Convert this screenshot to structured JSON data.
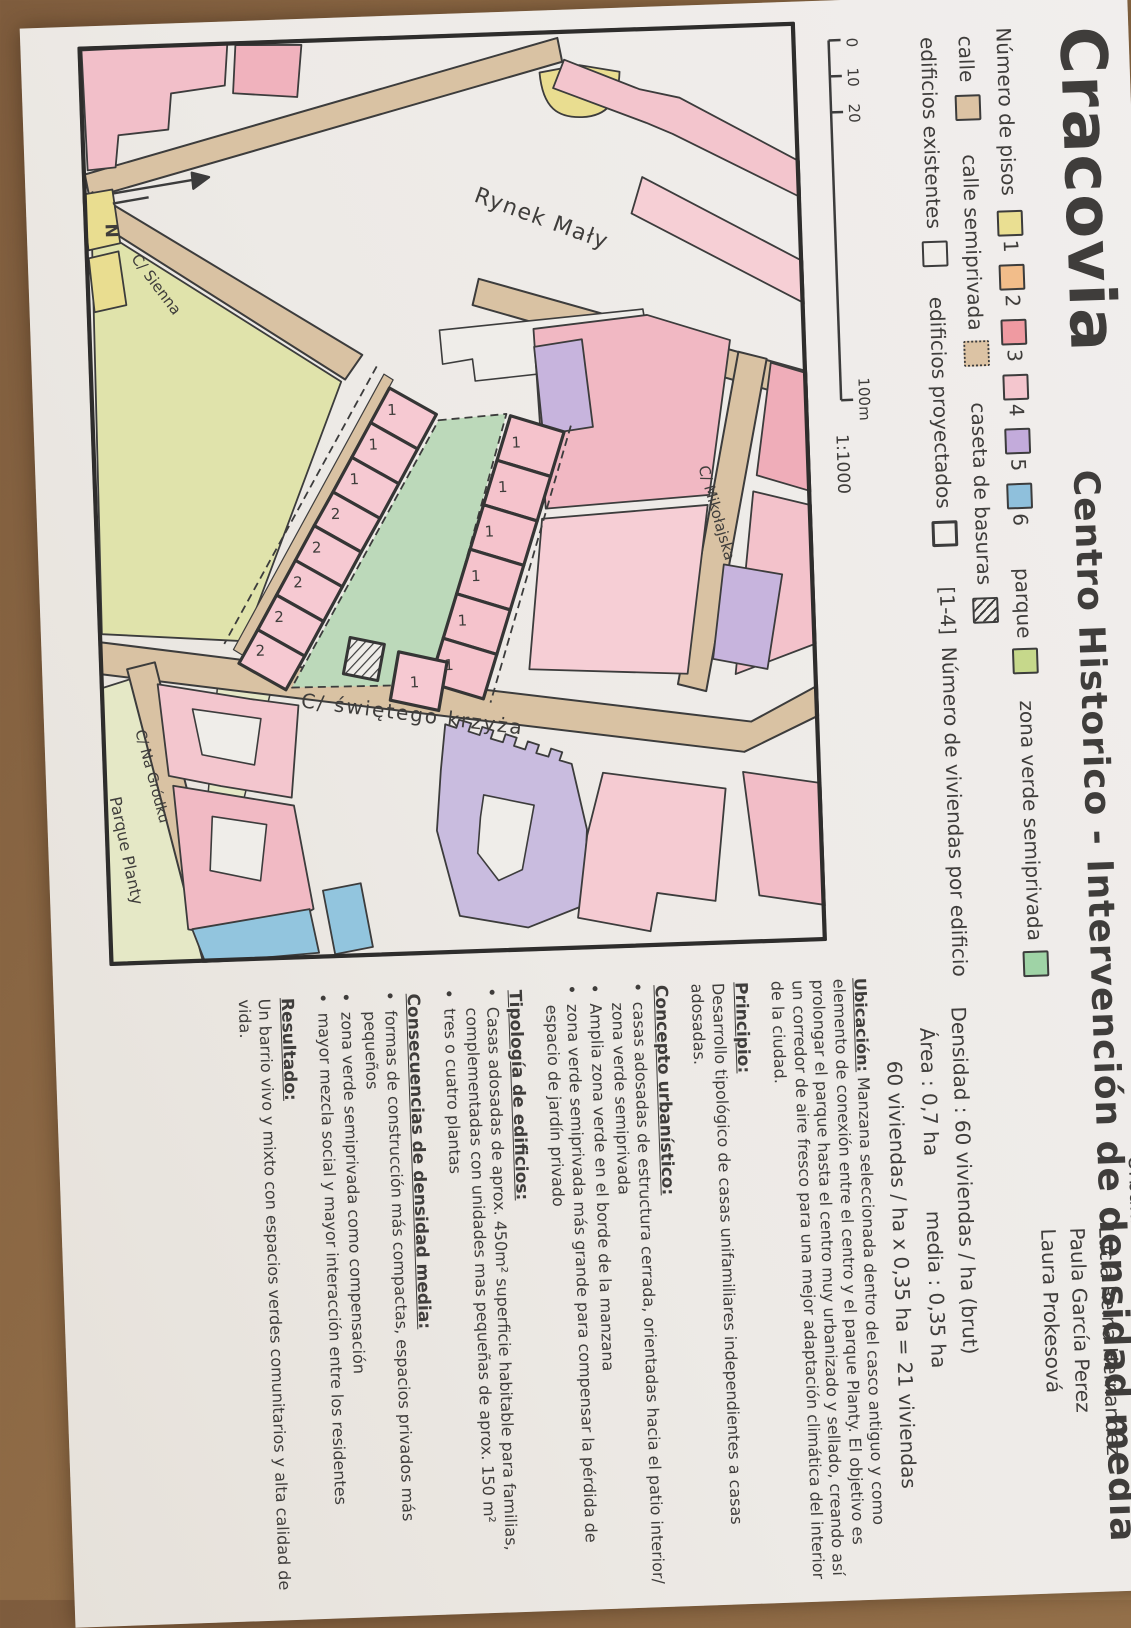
{
  "header": {
    "title_main": "Cracovia",
    "title_sub": "Centro Historico - Intervención de densidad media",
    "course": "Urbanismo 1",
    "term": "25/26",
    "group": "Grupo A",
    "authors": [
      "Lucía Reina Hernandez",
      "Paula García Perez",
      "Laura Prokesová"
    ]
  },
  "legend": {
    "pisos_label": "Número de pisos",
    "pisos": [
      {
        "n": "1",
        "color": "#eadf92"
      },
      {
        "n": "2",
        "color": "#f2bd8a"
      },
      {
        "n": "3",
        "color": "#ef9aa1"
      },
      {
        "n": "4",
        "color": "#f4c6ce"
      },
      {
        "n": "5",
        "color": "#c3abdb"
      },
      {
        "n": "6",
        "color": "#8fc0dc"
      }
    ],
    "parque_label": "parque",
    "parque_color": "#c6d88b",
    "zona_label": "zona verde semiprivada",
    "zona_color": "#9fd3a6",
    "calle_label": "calle",
    "calle_color": "#dcc3a4",
    "calle_semi_label": "calle semiprivada",
    "calle_semi_color": "#dcc3a4",
    "caseta_label": "caseta de basuras",
    "edif_exist_label": "edificios existentes",
    "edif_proy_label": "edificios proyectados",
    "viviendas_note_prefix": "[1-4]",
    "viviendas_note": "Número de viviendas por edificio"
  },
  "scale": {
    "ticks": [
      "0",
      "10",
      "20"
    ],
    "end": "100m",
    "ratio": "1:1000"
  },
  "density": {
    "line1": "Densidad : 60 viviendas / ha (brut)",
    "line2_area": "Área :  0,7 ha",
    "line2_media": "media :  0,35 ha",
    "line3": "60 viviendas / ha  x  0,35 ha = 21 viviendas"
  },
  "map": {
    "north_label": "N",
    "labels": {
      "rynek": "Rynek Mały",
      "sienna": "C/ Sienna",
      "mikolajska": "C/ Mikołajska",
      "krzyza": "C/ świętego krzyża",
      "grodku": "C/ Na Gródku",
      "planty": "Parque Planty"
    },
    "house_numbers": {
      "west": [
        "1",
        "1",
        "1",
        "2",
        "2",
        "2",
        "2",
        "2"
      ],
      "east": [
        "1",
        "1",
        "1",
        "1",
        "1",
        "1"
      ],
      "extra": [
        "1"
      ]
    }
  },
  "notes": {
    "ubicacion_title": "Ubicación:",
    "ubicacion_text": "Manzana seleccionada dentro del casco antiguo y como elemento de conexión entre el centro y el parque Planty. El objetivo es prolongar el parque hasta el centro muy urbanizado y sellado, creando así un corredor de aire fresco para una mejor adaptación climática del interior de la ciudad.",
    "principio_title": "Principio:",
    "principio_text": "Desarrollo tipológico de casas unifamiliares independientes a casas adosadas.",
    "concepto_title": "Concepto urbanístico:",
    "concepto_bullets": [
      "casas adosadas de estructura cerrada, orientadas hacia el patio interior/ zona verde semiprivada",
      "Amplia zona verde en el borde de la manzana",
      "zona verde semiprivada más grande para compensar la pérdida de espacio de jardín privado"
    ],
    "tipologia_title": "Tipología de edificios:",
    "tipologia_bullets": [
      "Casas adosadas de aprox. 450m² superficie habitable para familias, complementadas con unidades mas pequeñas de aprox. 150 m²",
      "tres o cuatro plantas"
    ],
    "consecuencias_title": "Consecuencias de densidad media:",
    "consecuencias_bullets": [
      "formas de construcción más compactas, espacios privados más pequeños",
      "zona verde semiprivada como compensación",
      "mayor mezcla social y mayor interacción entre los residentes"
    ],
    "resultado_title": "Resultado:",
    "resultado_text": "Un barrio vivo y mixto con espacios verdes comunitarios y alta calidad de vida."
  }
}
